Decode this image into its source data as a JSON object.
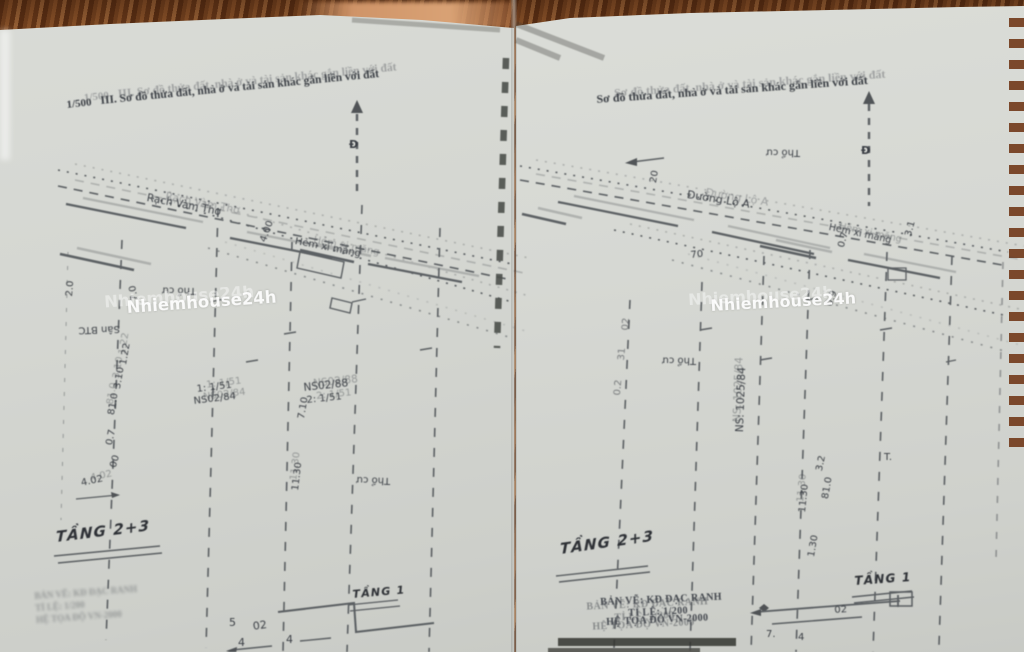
{
  "watermark": "Nhiemhouse24h",
  "caption": {
    "line1": "BẢN VẼ: KĐ ĐẠC RANH",
    "line2": "TỈ LỆ: 1/200",
    "line3": "HỆ TỌA ĐỘ VN-2000"
  },
  "left": {
    "scale": "1/500",
    "title": "III. Sơ đồ thửa đất, nhà ở và tài sản khác gắn liền với đất",
    "north": "Đ",
    "canal": "Rạch Vàm Thơ",
    "alley": "Hẻm xi măng",
    "tho_cu": "Thổ cư",
    "san_btc": "Sân BTC",
    "d400": "4.00",
    "d70": "7.0",
    "d20": "2.0",
    "d122": "1.22",
    "d310": "3.10",
    "d810": "81.0",
    "d07": "0.7",
    "d00": "00",
    "d402": "4.02",
    "d710": "7.10",
    "d1130": "11.30",
    "plot_a_scale": "1: 1/51",
    "plot_a_id": "NS02/84",
    "plot_b_id": "NS02/88",
    "plot_b_scale": "2: 1/51",
    "tang_upper": "TẦNG 2+3",
    "tang_ground": "TẦNG 1",
    "d5": "5",
    "d02": "02",
    "d4a": "4",
    "d4b": "4"
  },
  "right": {
    "title": "Sơ đồ thửa đất, nhà ở và tài sản khác gắn liền với đất",
    "north": "Đ",
    "road": "Đường Lộ A",
    "alley": "Hẻm xi măng",
    "tho_cu": "Thổ cư",
    "ns": "NS: 1025/84",
    "d20": "20",
    "d70": "70",
    "d07": "0.7",
    "d31": "3.1",
    "d09": "0.9",
    "col_a": "02",
    "col_b": "31",
    "col_c": "0.2",
    "d1130": "11.30",
    "d130": "1.30",
    "d32": "3.2",
    "d810": "81.0",
    "t_label": "T.",
    "tang_upper": "TẦNG 2+3",
    "tang_ground": "TẦNG 1",
    "b02": "02",
    "b7": "7.",
    "b4": "4"
  }
}
